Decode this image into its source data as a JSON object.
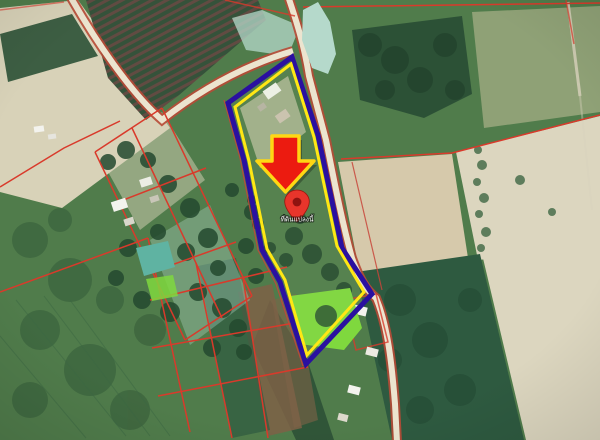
{
  "map_overlay": {
    "pin_label": "ที่ดินแปลงนี้",
    "arrow_icon": "red-arrow-down",
    "pin_icon": "red-map-pin",
    "highlight_outline": [
      "navy-outer-line",
      "yellow-inner-line"
    ],
    "boundary_lines": "red-cadastral-lines"
  },
  "colors": {
    "cadastral_red": "#d93a2b",
    "road_edge_red": "#b84a36",
    "road_fill": "#ece4cf",
    "parcel_outer_navy": "#2a10a0",
    "parcel_inner_yellow": "#ffe714",
    "parcel_outer_red": "#c8453a",
    "arrow_red": "#ec1b10",
    "arrow_yellow": "#ffd713",
    "pin_red": "#e8352b",
    "pin_stroke": "#9d140d",
    "pin_hole": "#8f1310",
    "pin_label_color": "#ffffff",
    "base_green": "#507c4b",
    "pale_field": "#d8d2b8",
    "pale_field2": "#dcd6bf",
    "tan_field": "#d6c9ab",
    "olive_field": "#9aa87e",
    "forest_dark": "#2c5136",
    "forest_blob": "#24492f",
    "se_dark_green": "#2e5a40",
    "brown_field": "#7e6247",
    "plantation_dark": "#35523a",
    "plantation_row": "#6b4a43",
    "pond_teal": "#b5d9cb",
    "farm_pond_teal": "#5fb3a2",
    "pond_bright_green": "#7fd83e",
    "building_white": "#f3f3ee",
    "furrow_green": "#3c6743",
    "track_pale": "#d8d2bd"
  }
}
